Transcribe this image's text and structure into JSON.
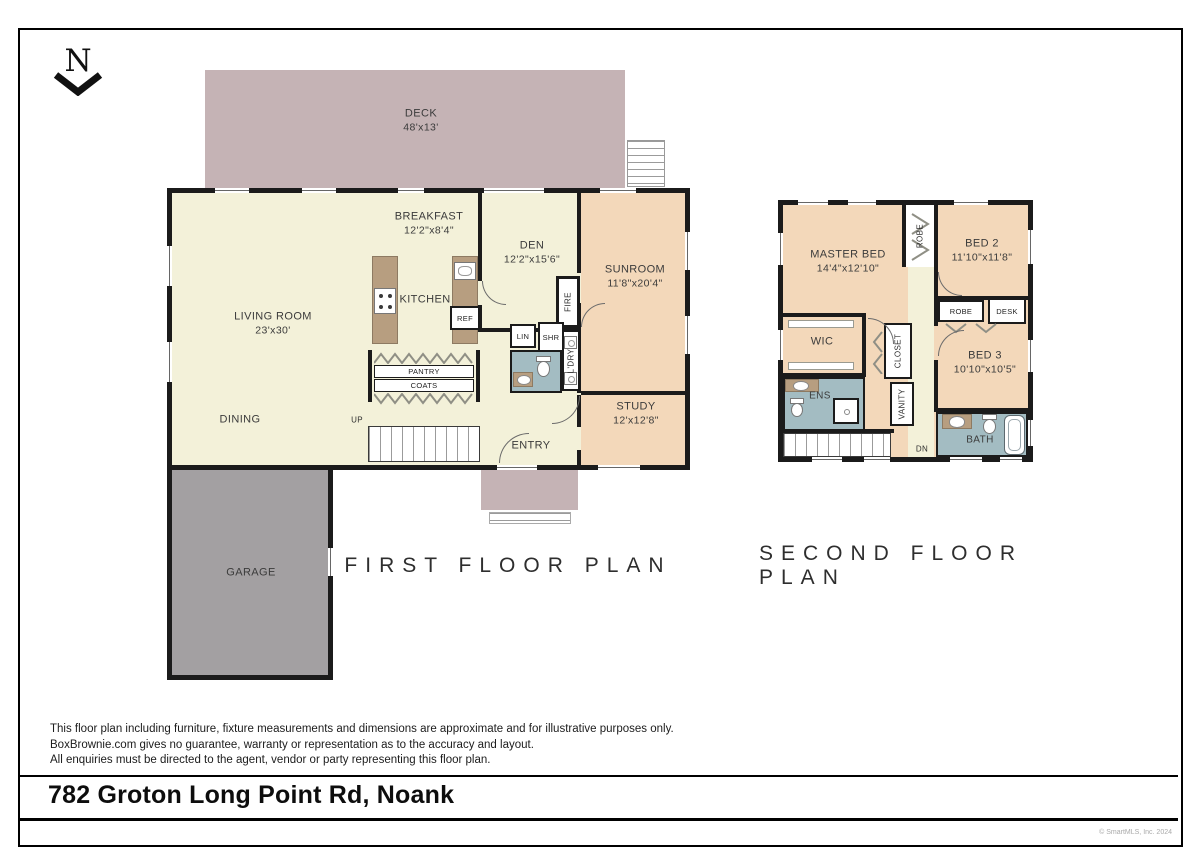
{
  "header": {
    "north_letter": "N"
  },
  "first_floor": {
    "title": "FIRST FLOOR PLAN",
    "rooms": {
      "deck": {
        "name": "DECK",
        "dims": "48'x13'"
      },
      "breakfast": {
        "name": "BREAKFAST",
        "dims": "12'2\"x8'4\""
      },
      "den": {
        "name": "DEN",
        "dims": "12'2\"x15'6\""
      },
      "sunroom": {
        "name": "SUNROOM",
        "dims": "11'8\"x20'4\""
      },
      "living_room": {
        "name": "LIVING ROOM",
        "dims": "23'x30'"
      },
      "kitchen": {
        "name": "KITCHEN"
      },
      "study": {
        "name": "STUDY",
        "dims": "12'x12'8\""
      },
      "dining": {
        "name": "DINING"
      },
      "entry": {
        "name": "ENTRY"
      },
      "garage": {
        "name": "GARAGE"
      }
    },
    "fixtures": {
      "ref": "REF",
      "fire": "FIRE",
      "lin": "LIN",
      "shr": "SHR",
      "ldry": "L'DRY",
      "pantry": "PANTRY",
      "coats": "COATS",
      "up": "UP"
    }
  },
  "second_floor": {
    "title": "SECOND FLOOR PLAN",
    "rooms": {
      "master_bed": {
        "name": "MASTER BED",
        "dims": "14'4\"x12'10\""
      },
      "bed2": {
        "name": "BED 2",
        "dims": "11'10\"x11'8\""
      },
      "bed3": {
        "name": "BED 3",
        "dims": "10'10\"x10'5\""
      },
      "wic": {
        "name": "WIC"
      },
      "ens": {
        "name": "ENS"
      },
      "bath": {
        "name": "BATH"
      }
    },
    "fixtures": {
      "robe_top": "ROBE",
      "robe_small": "ROBE",
      "desk": "DESK",
      "closet": "CLOSET",
      "vanity": "VANITY",
      "dn": "DN"
    }
  },
  "footer": {
    "disclaimer_line1": "This floor plan including furniture, fixture measurements and dimensions are approximate and for illustrative purposes only.",
    "disclaimer_line2": "BoxBrownie.com gives no guarantee, warranty or representation as to the accuracy and layout.",
    "disclaimer_line3": "All enquiries must be directed to the agent, vendor or party representing this floor plan.",
    "address": "782 Groton Long Point Rd, Noank",
    "credit": "© SmartMLS, Inc. 2024"
  },
  "colors": {
    "wall": "#1b1b1b",
    "living": "#f3f1d9",
    "bedroom": "#f3d8ba",
    "bath": "#a3bcc2",
    "deck": "#c5b3b5",
    "garage": "#a3a0a2",
    "counter": "#b79e80"
  }
}
